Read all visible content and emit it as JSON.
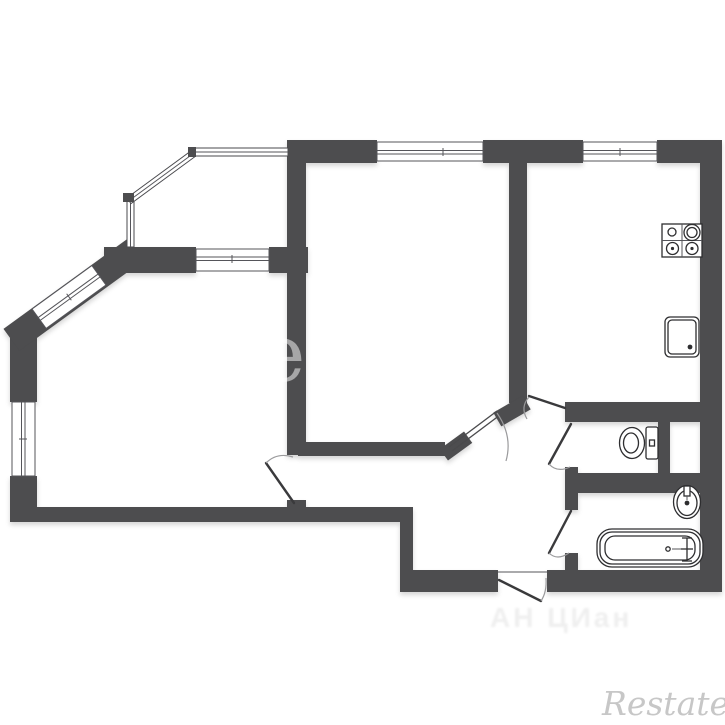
{
  "canvas": {
    "width": 725,
    "height": 725,
    "background": "#ffffff"
  },
  "plan": {
    "type": "apartment-floor-plan",
    "wall_color": "#4d4d4f",
    "window_line_color": "#55555a",
    "door_leaf_color": "#3a3a3c",
    "door_arc_color": "#9a9a9c",
    "fixture_line_color": "#2e2e30",
    "regions": [
      "bay-window",
      "living-room",
      "bedroom",
      "kitchen",
      "hallway",
      "wc",
      "bathroom"
    ],
    "fixtures": [
      "stove",
      "kitchen-sink",
      "toilet",
      "wash-basin",
      "bathtub"
    ],
    "window_count": 5,
    "door_count": 6
  },
  "watermarks": {
    "brand": "Restate",
    "agency": "АН ЦИан",
    "wall_letter": "e"
  }
}
